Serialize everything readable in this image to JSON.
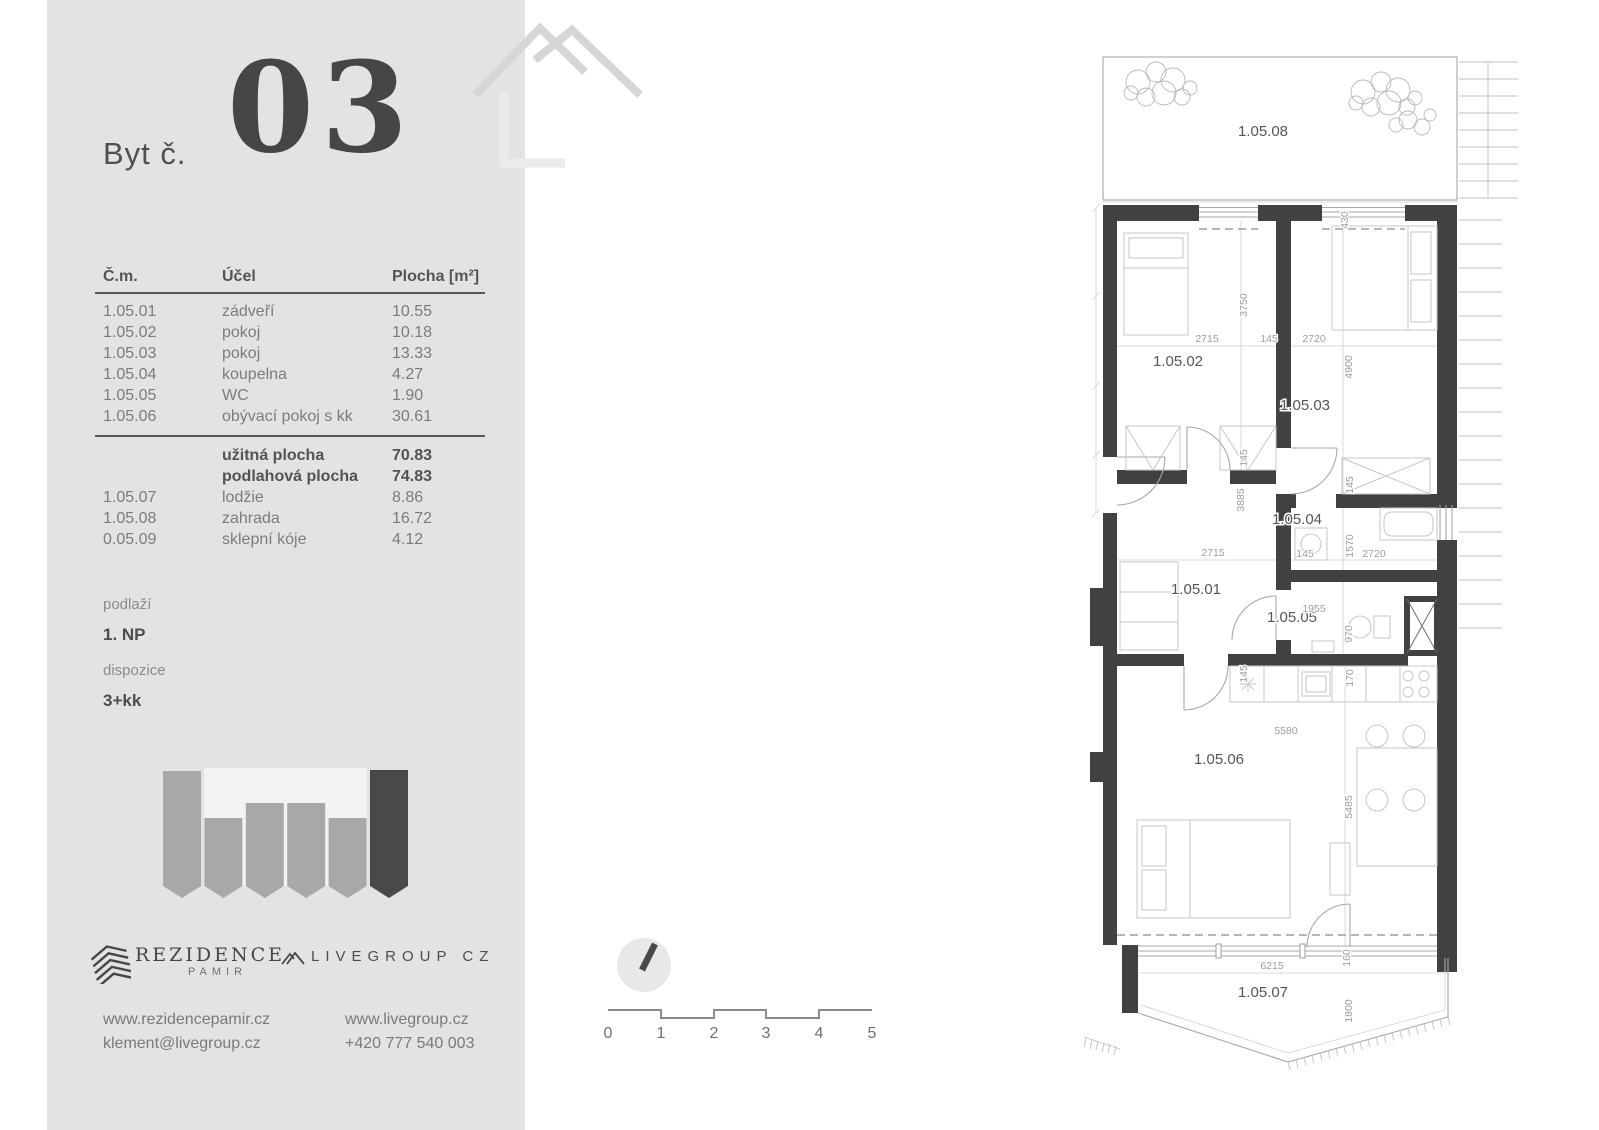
{
  "page": {
    "sidebar_bg": "#e3e3e3",
    "wall_color": "#3f4143",
    "accent_dark": "#454648",
    "text_gray": "#7b7c7f"
  },
  "sidebar": {
    "unit_label": "Byt č.",
    "unit_number": "03",
    "table": {
      "headers": {
        "id": "Č.m.",
        "purpose": "Účel",
        "area": "Plocha [m²]"
      },
      "rows": [
        {
          "id": "1.05.01",
          "purpose": "zádveří",
          "area": "10.55"
        },
        {
          "id": "1.05.02",
          "purpose": "pokoj",
          "area": "10.18"
        },
        {
          "id": "1.05.03",
          "purpose": "pokoj",
          "area": "13.33"
        },
        {
          "id": "1.05.04",
          "purpose": "koupelna",
          "area": "4.27"
        },
        {
          "id": "1.05.05",
          "purpose": "WC",
          "area": "1.90"
        },
        {
          "id": "1.05.06",
          "purpose": "obývací pokoj s kk",
          "area": "30.61"
        }
      ],
      "summary": [
        {
          "purpose": "užitná plocha",
          "area": "70.83"
        },
        {
          "purpose": "podlahová plocha",
          "area": "74.83"
        }
      ],
      "extra_rows": [
        {
          "id": "1.05.07",
          "purpose": "lodžie",
          "area": "8.86"
        },
        {
          "id": "1.05.08",
          "purpose": "zahrada",
          "area": "16.72"
        },
        {
          "id": "0.05.09",
          "purpose": "sklepní kóje",
          "area": "4.12"
        }
      ]
    },
    "floor_label": "podlaží",
    "floor_value": "1. NP",
    "layout_label": "dispozice",
    "layout_value": "3+kk",
    "brand_rezidence": {
      "name": "REZIDENCE",
      "sub": "PAMIR"
    },
    "brand_livegroup": "LIVEGROUP CZ",
    "contacts": {
      "web_pamir": "www.rezidencepamir.cz",
      "email": "klement@livegroup.cz",
      "web_livegroup": "www.livegroup.cz",
      "phone": "+420 777 540 003"
    }
  },
  "scalebar": {
    "labels": [
      "0",
      "1",
      "2",
      "3",
      "4",
      "5"
    ]
  },
  "floorplan": {
    "rooms": [
      "1.05.08",
      "1.05.02",
      "1.05.03",
      "1.05.04",
      "1.05.01",
      "1.05.05",
      "1.05.06",
      "1.05.07"
    ],
    "dims": [
      "430",
      "3750",
      "2715",
      "145",
      "2720",
      "4900",
      "145",
      "3885",
      "145",
      "2715",
      "145",
      "1570",
      "2720",
      "1955",
      "970",
      "145",
      "170",
      "5580",
      "5485",
      "160",
      "6215",
      "1800"
    ]
  }
}
